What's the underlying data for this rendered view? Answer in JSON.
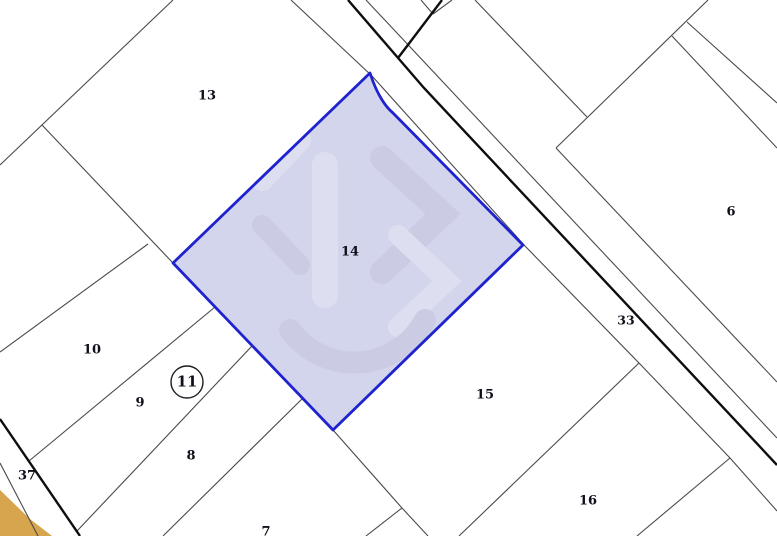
{
  "map": {
    "width": 777,
    "height": 536,
    "background": "#ffffff",
    "colors": {
      "thin_line": "#4a4a4a",
      "thick_line": "#0e0e0e",
      "selected_fill": "#d3d5ec",
      "selected_stroke": "#1f23cf",
      "watermark_light": "#dfe1f3",
      "watermark_dark": "#c9cbe2",
      "tan_fill": "#d6a54d",
      "label_color": "#10101c"
    },
    "selected_parcel": {
      "name": "selected-parcel-14",
      "label": "14",
      "path": "M370,73 Q379,101 393,113 L523,245 L333,430 L173,263 Z"
    },
    "tan_area": {
      "name": "tan-parcel-area",
      "points": "0,490 30,519 52,536 0,536"
    },
    "watermark_strokes": [
      {
        "d": "M325,165 L325,295",
        "w": 26,
        "tone": "light"
      },
      {
        "d": "M382,158 L443,214 L382,272",
        "w": 24,
        "tone": "dark"
      },
      {
        "d": "M398,235 L447,281 L398,327",
        "w": 20,
        "tone": "light"
      },
      {
        "d": "M290,330 A80,80 0 0 0 425,320",
        "w": 22,
        "tone": "dark"
      },
      {
        "d": "M300,140 L262,180",
        "w": 22,
        "tone": "light"
      },
      {
        "d": "M262,225 L300,265",
        "w": 20,
        "tone": "dark"
      }
    ],
    "thin_lines": [
      {
        "name": "boundary-13-upperleft",
        "points": "0,165 173,0"
      },
      {
        "name": "boundary-13-lowerleft",
        "points": "42,125 173,263"
      },
      {
        "name": "divider-strip10-top",
        "points": "0,352 148,244"
      },
      {
        "name": "divider-10-9",
        "points": "29,461 215,307"
      },
      {
        "name": "divider-9-8",
        "points": "77,531 252,346"
      },
      {
        "name": "divider-8-7",
        "points": "163,536 303,398"
      },
      {
        "name": "road37-left-edge",
        "points": "0,463 38,536"
      },
      {
        "name": "road33-left-edge",
        "points": "291,0 372,76 525,246 639,363 730,458 777,511"
      },
      {
        "name": "road33-right-edge",
        "points": "366,0 777,438"
      },
      {
        "name": "junction-spur",
        "points": "475,0 587,117"
      },
      {
        "name": "parcel6-upperleft-boundary",
        "points": "708,0 556,148"
      },
      {
        "name": "parcel6-lowerleft-boundary",
        "points": "556,148 777,382"
      },
      {
        "name": "branch-road-upper-edge",
        "points": "687,22 777,103"
      },
      {
        "name": "branch-road-lower-edge",
        "points": "672,36 777,148"
      },
      {
        "name": "divider-15-16",
        "points": "639,363 459,536"
      },
      {
        "name": "divider-16-right",
        "points": "730,458 637,536"
      },
      {
        "name": "divider-7-15",
        "points": "333,430 402,508"
      },
      {
        "name": "divider-7-15-south",
        "points": "402,508 428,536"
      },
      {
        "name": "divider-7-sliver",
        "points": "402,508 366,536"
      },
      {
        "name": "junction-notch-left",
        "points": "421,0 433,14"
      },
      {
        "name": "junction-notch-right",
        "points": "433,14 452,0"
      }
    ],
    "thick_lines": [
      {
        "name": "main-road-centerline",
        "points": "348,0 424,88 777,465"
      },
      {
        "name": "main-road-branch",
        "points": "442,0 398,58"
      },
      {
        "name": "road37-thick-edge",
        "points": "0,419 80,536"
      }
    ],
    "labels": [
      {
        "name": "parcel-label-13",
        "text": "13",
        "x": 207,
        "y": 96,
        "size": 13
      },
      {
        "name": "parcel-label-14",
        "text": "14",
        "x": 350,
        "y": 252,
        "size": 13
      },
      {
        "name": "parcel-label-6",
        "text": "6",
        "x": 731,
        "y": 212,
        "size": 13
      },
      {
        "name": "parcel-label-33",
        "text": "33",
        "x": 626,
        "y": 321,
        "size": 12.5
      },
      {
        "name": "parcel-label-10",
        "text": "10",
        "x": 92,
        "y": 350,
        "size": 13
      },
      {
        "name": "parcel-label-9",
        "text": "9",
        "x": 140,
        "y": 403,
        "size": 13
      },
      {
        "name": "parcel-label-8",
        "text": "8",
        "x": 191,
        "y": 456,
        "size": 13
      },
      {
        "name": "parcel-label-37",
        "text": "37",
        "x": 27,
        "y": 476,
        "size": 13
      },
      {
        "name": "parcel-label-7",
        "text": "7",
        "x": 266,
        "y": 532,
        "size": 13
      },
      {
        "name": "parcel-label-15",
        "text": "15",
        "x": 485,
        "y": 395,
        "size": 13
      },
      {
        "name": "parcel-label-16",
        "text": "16",
        "x": 588,
        "y": 501,
        "size": 13
      }
    ],
    "circled_label": {
      "name": "parcel-11-badge",
      "text": "11",
      "cx": 187,
      "cy": 382,
      "r": 16,
      "text_size": 15
    }
  }
}
